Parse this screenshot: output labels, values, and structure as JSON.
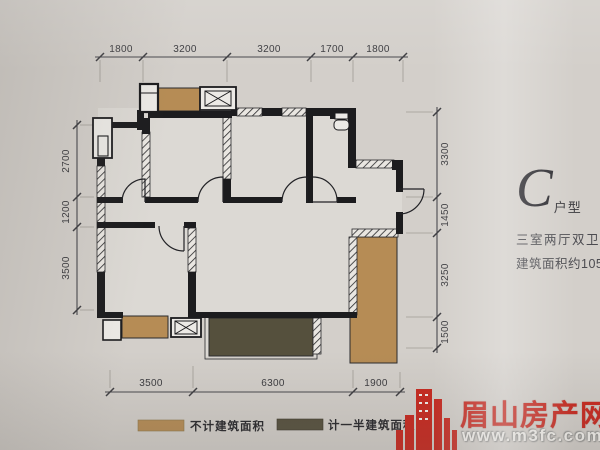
{
  "unit": {
    "letter": "C",
    "letter_suffix": "户型",
    "layout": "三室两厅双卫",
    "area": "建筑面积约105m²"
  },
  "dimensions": {
    "top": [
      "1800",
      "3200",
      "3200",
      "1700",
      "1800"
    ],
    "left": [
      "2700",
      "1200",
      "3500"
    ],
    "right": [
      "3300",
      "1450",
      "3250",
      "1500"
    ],
    "bottom": [
      "3500",
      "6300",
      "1900"
    ]
  },
  "legend": {
    "items": [
      {
        "label": "不计建筑面积",
        "color": "#b68c55"
      },
      {
        "label": "计一半建筑面积",
        "color": "#55503d"
      }
    ]
  },
  "watermark": {
    "site_name": "眉山房产网",
    "site_url": "www.m3fc.com",
    "color": "#c8271e"
  },
  "colors": {
    "background": "#d3cfca",
    "wall": "#1c1c1e",
    "dimension_text": "#3a3a3e"
  }
}
